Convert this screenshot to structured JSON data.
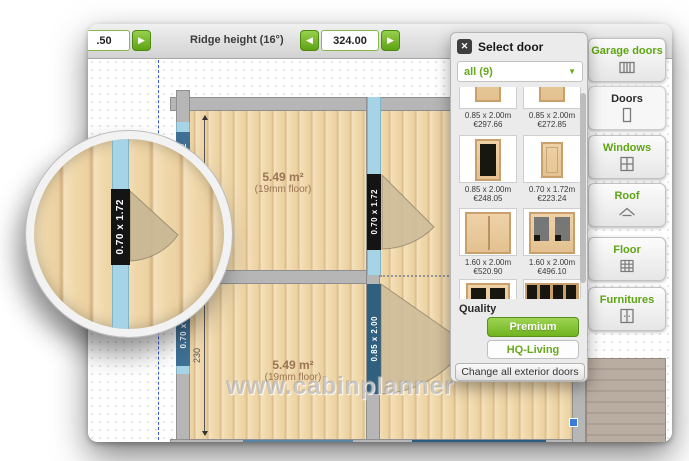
{
  "toolbar": {
    "left_value": ".50",
    "ridge_label": "Ridge height (16°)",
    "ridge_value": "324.00"
  },
  "icons": {
    "close": "✕",
    "arrow_left": "◀",
    "arrow_right": "▶",
    "dropdown_arrow": "▼"
  },
  "panel": {
    "title": "Select door",
    "filter_value": "all (9)",
    "items": [
      {
        "size": "0.85 x 2.00m",
        "price": "€297.66"
      },
      {
        "size": "0.85 x 2.00m",
        "price": "€272.85"
      },
      {
        "size": "0.85 x 2.00m",
        "price": "€248.05"
      },
      {
        "size": "0.70 x 1.72m",
        "price": "€223.24"
      },
      {
        "size": "1.60 x 2.00m",
        "price": "€520.90"
      },
      {
        "size": "1.60 x 2.00m",
        "price": "€496.10"
      },
      {
        "size": "",
        "price": ""
      },
      {
        "size": "",
        "price": ""
      }
    ],
    "quality_label": "Quality",
    "quality_options": [
      "Premium",
      "HQ-Living"
    ],
    "quality_selected": "Premium",
    "change_all_label": "Change all exterior doors"
  },
  "sidebar": {
    "active": "Doors",
    "items": [
      {
        "label": "Garage doors"
      },
      {
        "label": "Doors"
      },
      {
        "label": "Windows"
      },
      {
        "label": "Roof"
      },
      {
        "label": "Floor"
      },
      {
        "label": "Furnitures"
      }
    ]
  },
  "plan": {
    "rooms": [
      {
        "area": "5.49 m²",
        "floor": "(19mm floor)"
      },
      {
        "area": "5.49 m²",
        "floor": "(19mm floor)"
      }
    ],
    "dimension": "230",
    "openings": {
      "top_door": "0.70 x 1.72",
      "interior_door": "0.85 x 2.00",
      "left_window_top": "0.70 x 0.92",
      "left_window_bottom": "0.70 x 0.92",
      "bottom_door_left": "0.85 x 2.00",
      "bottom_door_right": "1.50 x 2.00"
    },
    "watermark": "www.cabinplanner"
  },
  "loupe": {
    "label": "0.70 x 1.72"
  },
  "colors": {
    "accent_green": "#76b82a",
    "door_strip_blue": "#a6d3e6",
    "label_dark_blue": "#2c5d80",
    "label_black": "#1b1b1b"
  }
}
